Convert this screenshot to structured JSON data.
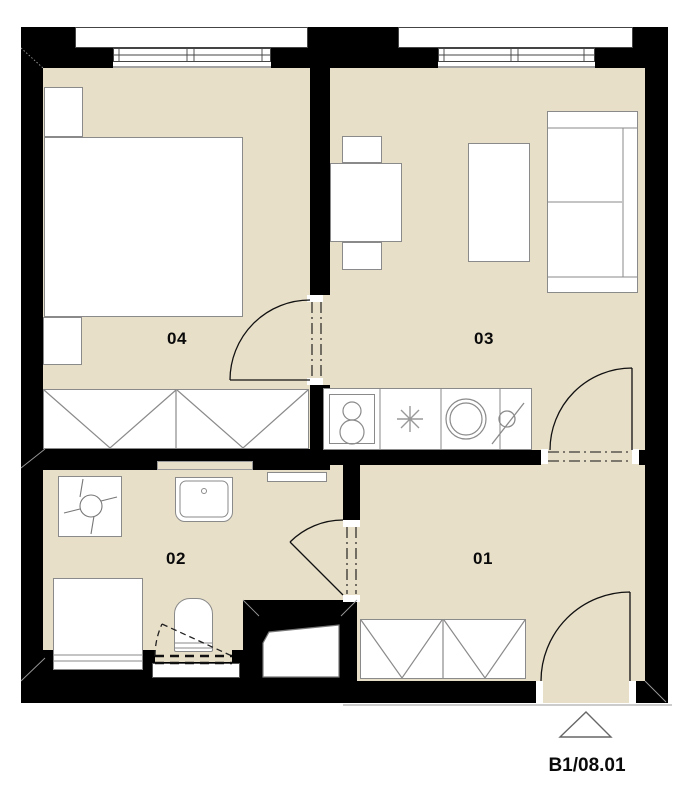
{
  "plan": {
    "rooms": [
      {
        "id": "04",
        "label": "04",
        "type": "bedroom"
      },
      {
        "id": "03",
        "label": "03",
        "type": "living-room-kitchen"
      },
      {
        "id": "02",
        "label": "02",
        "type": "bathroom"
      },
      {
        "id": "01",
        "label": "01",
        "type": "hall"
      }
    ],
    "unit_code": "B1/08.01",
    "entrance_marker": "triangle"
  },
  "fixtures": [
    "bed",
    "nightstand",
    "wardrobe",
    "dining-table",
    "chair",
    "cabinet",
    "sofa",
    "kitchen-counter",
    "stove",
    "kitchen-sink",
    "faucet",
    "washing-machine",
    "wash-basin",
    "radiator",
    "bathtub",
    "toilet",
    "utility-shaft",
    "window",
    "door"
  ],
  "colors": {
    "floor": "#e8dfc9",
    "wall": "#000000",
    "furniture_outline": "#8a8a8a",
    "door_line": "#111111",
    "background": "#ffffff"
  }
}
